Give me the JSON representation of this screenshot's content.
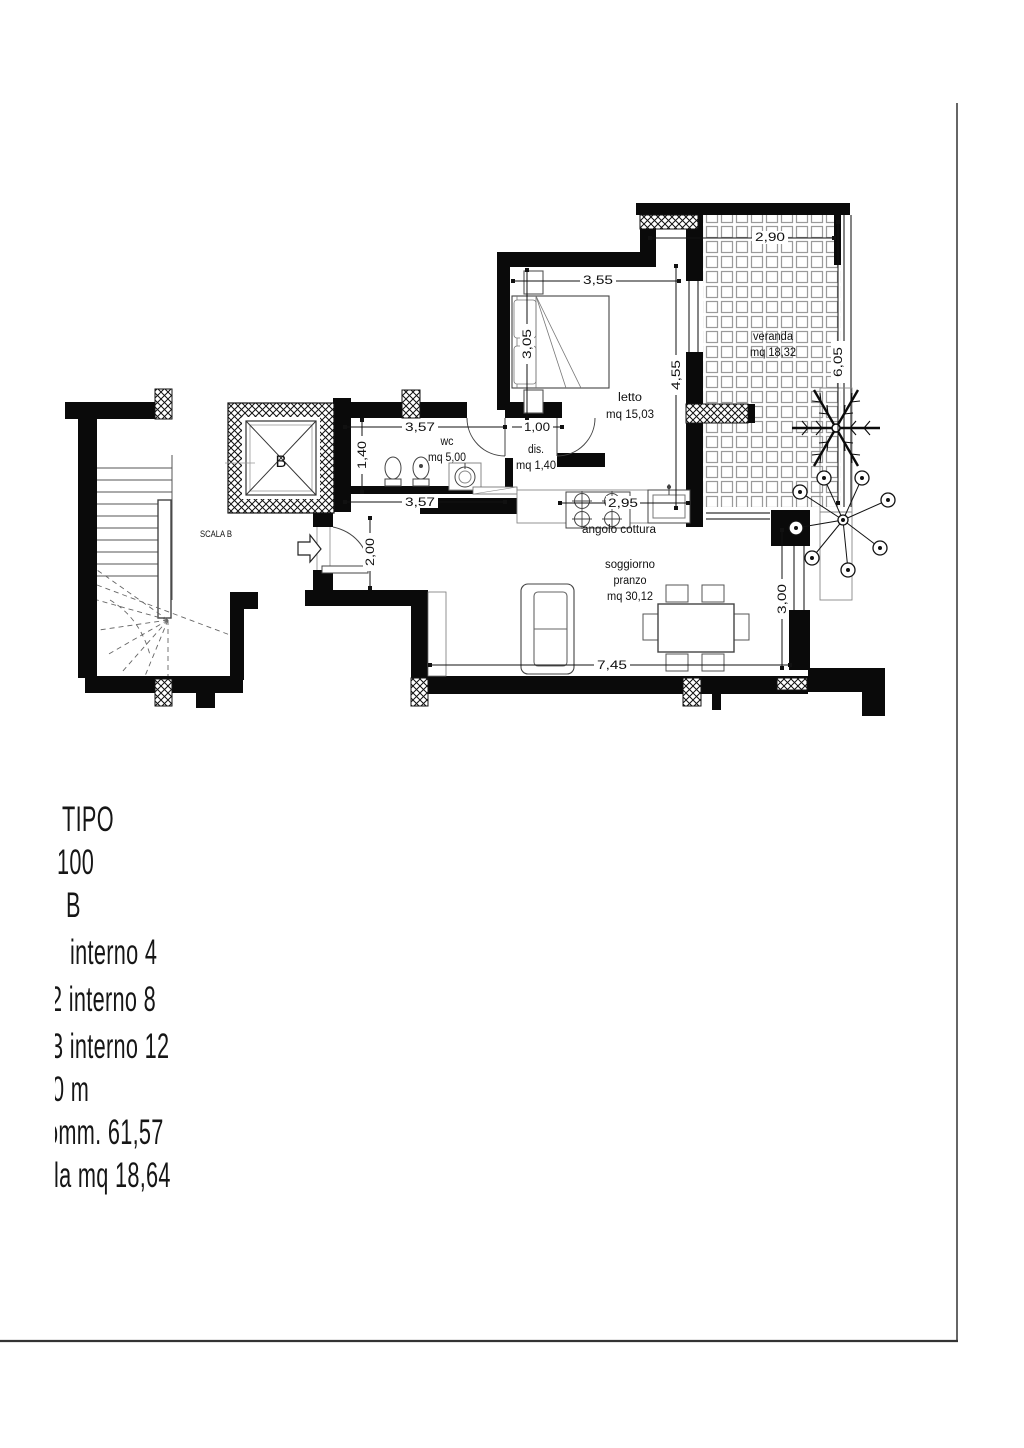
{
  "plan": {
    "rooms": {
      "veranda": {
        "label": "veranda",
        "area": "mq 18,32"
      },
      "letto": {
        "label": "letto",
        "area": "mq 15,03"
      },
      "wc": {
        "label": "wc",
        "area": "mq 5,00"
      },
      "dis": {
        "label": "dis.",
        "area": "mq 1,40"
      },
      "cucina": {
        "label": "angolo cottura"
      },
      "soggiorno": {
        "label": "soggiorno",
        "label2": "pranzo",
        "area": "mq 30,12"
      },
      "scala": {
        "label": "SCALA B"
      },
      "ascensore": {
        "label": "B"
      }
    },
    "dimensions": {
      "veranda_w": "2,90",
      "veranda_h": "6,05",
      "letto_w": "3,55",
      "letto_h1": "3,05",
      "letto_h2": "4,55",
      "wc_w_top": "3,57",
      "wc_h": "1,40",
      "wc_w_bot": "3,57",
      "dis_w": "1,00",
      "entry_h": "2,00",
      "cucina_w": "2,95",
      "soggiorno_w": "7,45",
      "soggiorno_h": "3,00"
    }
  },
  "title_block": {
    "lines": [
      "TIPO",
      "100",
      "B",
      "interno 4",
      "2 interno 8",
      "3 interno 12",
      "0 m",
      "omm. 61,57",
      "la mq 18,64"
    ]
  },
  "colors": {
    "ink": "#111111",
    "wall": "#0a0a0a",
    "tile_line": "#9a9a9a",
    "fixture_line": "#444444"
  }
}
